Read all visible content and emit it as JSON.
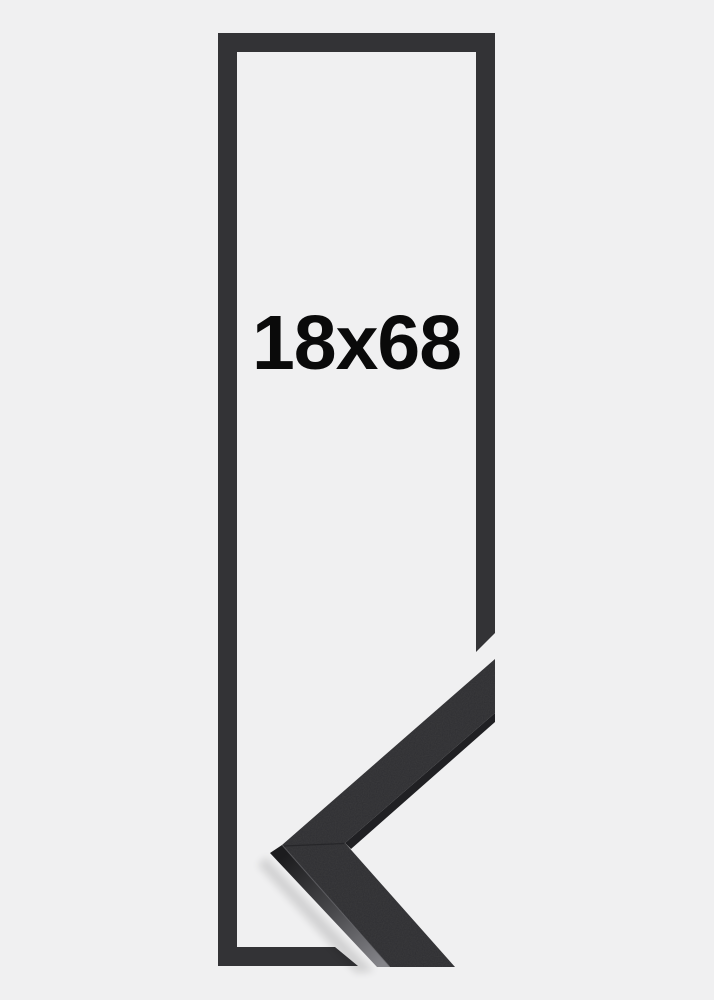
{
  "product": {
    "size_label": "18x68"
  },
  "colors": {
    "background": "#f0f0f1",
    "outline": "#333336",
    "frame_top": "#2e2e31",
    "frame_side_dark": "#1c1c1e",
    "frame_side_mid": "#48484b",
    "frame_side_light": "#85858a",
    "sliver": "#202023",
    "seam": "#1f1f22",
    "edge_highlight": "#6a6a6f",
    "shadow": "#000000",
    "text": "#0a0a0a"
  },
  "graphics": {
    "frame_outline": "tall rectangular frame outline with diagonal cutaway at lower right",
    "corner_profile": "3D mitered frame corner moulding sample pointing left"
  }
}
